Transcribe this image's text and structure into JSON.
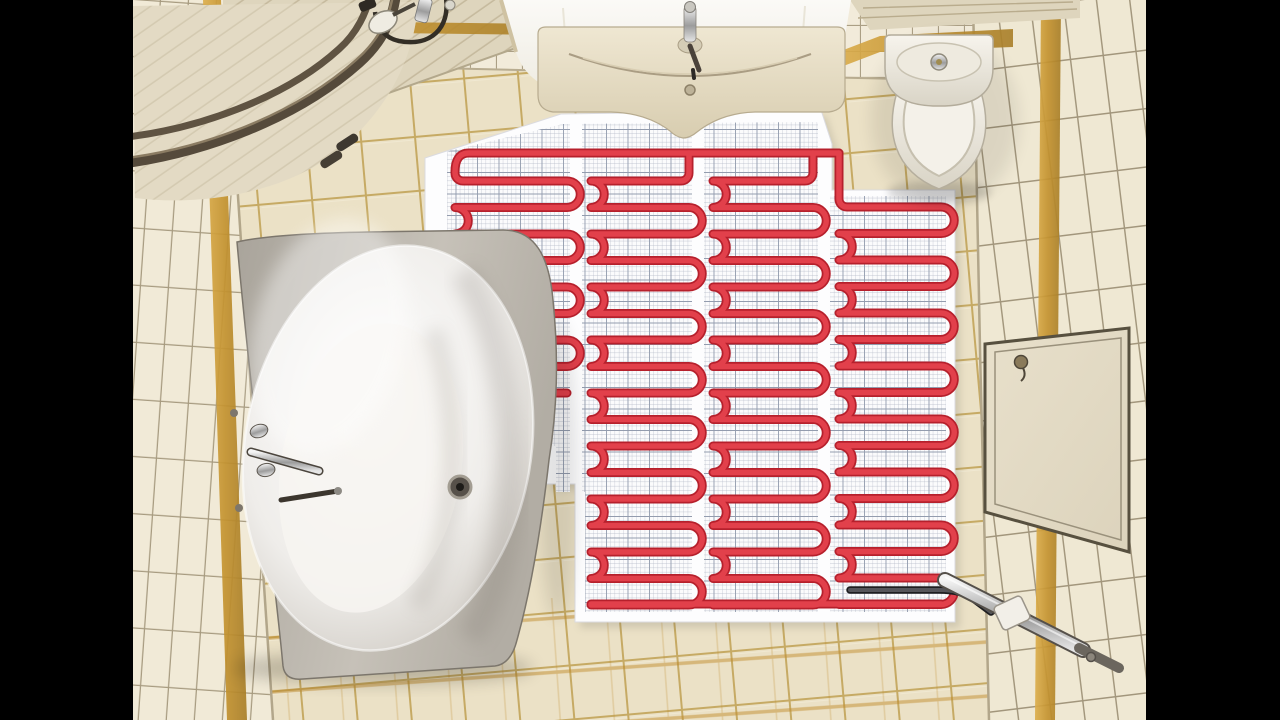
{
  "scene": {
    "label": "bathroom-top-view-underfloor-heating",
    "description": "Top-down view of a bathroom: corner bathtub, quarter-circle shower cabin, vanity sink, toilet, beige tiled walls and floor with gold accent stripes, white underlayment sheet with mesh grid and red electric heating cable laid in four serpentine columns, cold lead exiting to a chrome wall conduit, access panel on right wall."
  },
  "frame": {
    "left_bar_width": 133,
    "right_bar_width": 134,
    "bar_color": "#000000"
  },
  "colors": {
    "floor_tile": "#ebe1c6",
    "floor_grout": "#c6aa64",
    "floor_gold": "#c08c2e",
    "wall_tile": "#f1ead7",
    "wall_grout": "#a79b80",
    "gold_light": "#dcae4c",
    "gold_dark": "#b98a2c",
    "mat_sheet": "#fdfdfe",
    "mat_grid_line": "#b0b6c4",
    "mat_grid_bold": "#939cae",
    "cable_red": "#e2404b",
    "cable_red_dark": "#b6202c",
    "cold_lead": "#55555a",
    "cold_lead_dark": "#1e1e20",
    "rail_bronze": "#554a3b",
    "rail_bronze_light": "#8b7c63",
    "shower_tray": "#e6dec9",
    "soffit": "#ded5bd",
    "ceiling_white": "#f8f7f2",
    "vanity_cream": "#ece3cd",
    "porcelain": "#f6f3ec",
    "tub_shell": "#bcb7ae",
    "tub_inner": "#fcfbf9",
    "panel_face": "#e4dcc7",
    "panel_frame": "#57503f"
  },
  "heating_mat": {
    "pitch": 26.5,
    "turn_radius": 13.25,
    "cable_width": 5.5,
    "top_bus": "M 322 172 Q 322 153 336 153 L 706 153",
    "bottom_bus": "M 458 604 L 808 604",
    "cold_lead": "M 717 590 L 806 590 Q 830 590 842 600 L 858 612",
    "columns": [
      {
        "x1": 322,
        "x2": 434,
        "y_top": 181,
        "y_bottom": 394,
        "start": "left",
        "entry_y": 172
      },
      {
        "x1": 458,
        "x2": 556,
        "y_top": 181,
        "y_bottom": 606,
        "start": "right",
        "entry_y": 153
      },
      {
        "x1": 580,
        "x2": 680,
        "y_top": 181,
        "y_bottom": 606,
        "start": "right",
        "entry_y": 153
      },
      {
        "x1": 706,
        "x2": 808,
        "y_top": 207,
        "y_bottom": 606,
        "start": "left",
        "entry_y": 153
      }
    ]
  },
  "objects": [
    {
      "name": "heating-mat",
      "parts": [
        "underlay-sheet",
        "mesh-grid",
        "cable-columns",
        "top-bus",
        "bottom-bus",
        "cold-lead"
      ]
    },
    {
      "name": "bathtub",
      "parts": [
        "shell",
        "interior",
        "drain",
        "faucet"
      ]
    },
    {
      "name": "shower-cabin",
      "parts": [
        "tray",
        "drain-slots",
        "curved-door-rails",
        "shower-head",
        "hose"
      ]
    },
    {
      "name": "vanity-sink",
      "parts": [
        "cabinet",
        "basin-curves",
        "faucet",
        "overflow"
      ]
    },
    {
      "name": "toilet",
      "parts": [
        "cistern",
        "flush-button",
        "bowl",
        "seat",
        "hinges"
      ]
    },
    {
      "name": "access-panel",
      "parts": [
        "face",
        "frame",
        "knob"
      ]
    },
    {
      "name": "wall-conduit",
      "parts": [
        "chrome-bar",
        "plate",
        "screw"
      ]
    },
    {
      "name": "walls",
      "parts": [
        "left-wall",
        "back-wall",
        "right-wall",
        "gold-stripes",
        "ceiling-soffits",
        "ceiling-light-panel"
      ]
    }
  ]
}
